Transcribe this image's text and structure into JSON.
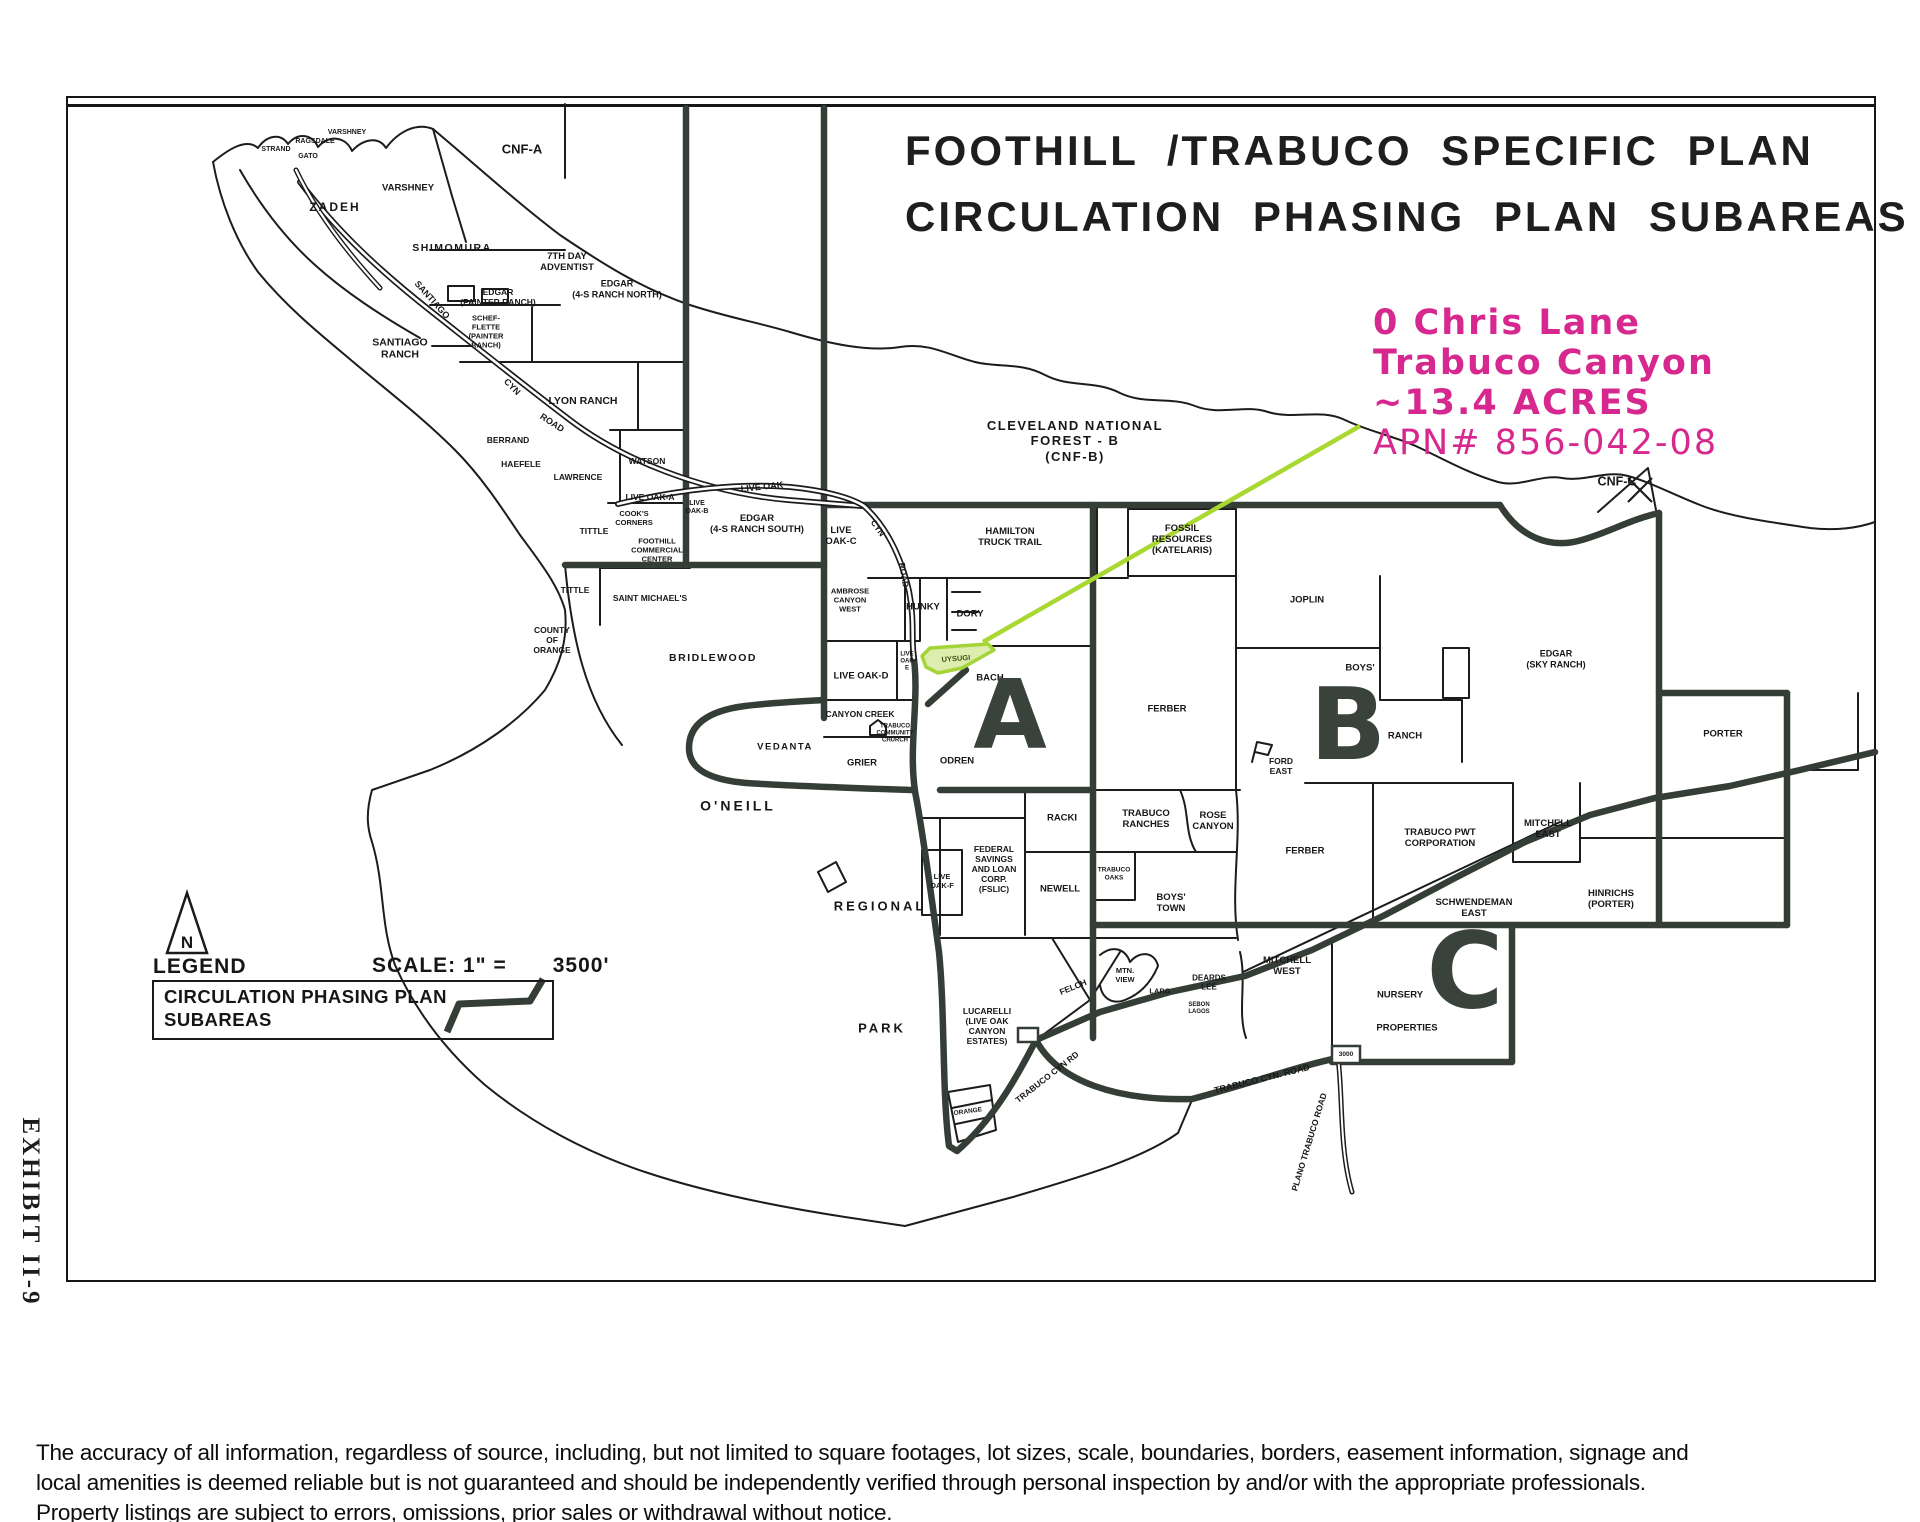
{
  "title": {
    "line1": "FOOTHILL /TRABUCO SPECIFIC PLAN",
    "line2": "CIRCULATION PHASING PLAN SUBAREAS"
  },
  "annotation": {
    "line1": "0 Chris Lane",
    "line2": "Trabuco Canyon",
    "line3": "~13.4 ACRES",
    "line4": "APN# 856-042-08",
    "text_color": "#d6288e",
    "leader_color": "#a9d832"
  },
  "exhibit": {
    "label": "EXHIBIT II-9"
  },
  "legend": {
    "heading": "LEGEND",
    "north_label": "N",
    "scale_label": "SCALE: 1\" =",
    "scale_value": "3500'",
    "box_line1": "CIRCULATION PHASING PLAN",
    "box_line2": "SUBAREAS"
  },
  "highlight": {
    "parcel_label": "UYSUGI",
    "fill": "#dcedad",
    "stroke": "#a4d437"
  },
  "subareas": [
    {
      "letter": "A",
      "x": 1010,
      "y": 716,
      "s": 95
    },
    {
      "letter": "B",
      "x": 1348,
      "y": 725,
      "s": 100
    },
    {
      "letter": "C",
      "x": 1465,
      "y": 972,
      "s": 105
    }
  ],
  "map_labels": [
    {
      "t": "CNF-A",
      "x": 522,
      "y": 149,
      "s": 13
    },
    {
      "t": "ZADEH",
      "x": 335,
      "y": 207,
      "s": 12,
      "ls": 2
    },
    {
      "t": "VARSHNEY",
      "x": 408,
      "y": 188,
      "s": 9.5
    },
    {
      "t": "VARSHNEY",
      "x": 347,
      "y": 133,
      "s": 7
    },
    {
      "t": "RAGSDALE",
      "x": 315,
      "y": 142,
      "s": 7
    },
    {
      "t": "STRAND",
      "x": 276,
      "y": 150,
      "s": 7
    },
    {
      "t": "GATO",
      "x": 308,
      "y": 157,
      "s": 7
    },
    {
      "t": "SHIMOMURA",
      "x": 452,
      "y": 248,
      "s": 10.5,
      "ls": 1.5
    },
    {
      "t": "7TH DAY\nADVENTIST",
      "x": 567,
      "y": 262,
      "s": 9.5
    },
    {
      "t": "EDGAR\n(PAINTER RANCH)",
      "x": 498,
      "y": 297,
      "s": 8.5
    },
    {
      "t": "SCHEF-\nFLETTE\n(PAINTER\nRANCH)",
      "x": 486,
      "y": 332,
      "s": 7.5
    },
    {
      "t": "SANTIAGO\nRANCH",
      "x": 400,
      "y": 349,
      "s": 10.5
    },
    {
      "t": "EDGAR\n(4-S RANCH NORTH)",
      "x": 617,
      "y": 289,
      "s": 9
    },
    {
      "t": "LYON RANCH",
      "x": 583,
      "y": 401,
      "s": 10.5
    },
    {
      "t": "BERRAND",
      "x": 508,
      "y": 440,
      "s": 8.5
    },
    {
      "t": "HAEFELE",
      "x": 521,
      "y": 464,
      "s": 8.5
    },
    {
      "t": "LAWRENCE",
      "x": 578,
      "y": 477,
      "s": 8.5
    },
    {
      "t": "WATSON",
      "x": 647,
      "y": 461,
      "s": 8.5
    },
    {
      "t": "LIVE OAK-A",
      "x": 650,
      "y": 497,
      "s": 8.5
    },
    {
      "t": "COOK'S\nCORNERS",
      "x": 634,
      "y": 519,
      "s": 7.5
    },
    {
      "t": "TITTLE",
      "x": 594,
      "y": 531,
      "s": 8.5
    },
    {
      "t": "TITTLE",
      "x": 575,
      "y": 590,
      "s": 8.5
    },
    {
      "t": "FOOTHILL\nCOMMERCIAL\nCENTER",
      "x": 657,
      "y": 551,
      "s": 7.5
    },
    {
      "t": "SAINT MICHAEL'S",
      "x": 650,
      "y": 598,
      "s": 8.5
    },
    {
      "t": "COUNTY\nOF\nORANGE",
      "x": 552,
      "y": 640,
      "s": 8.5
    },
    {
      "t": "BRIDLEWOOD",
      "x": 713,
      "y": 658,
      "s": 10.5,
      "ls": 1.5
    },
    {
      "t": "EDGAR\n(4-S RANCH SOUTH)",
      "x": 757,
      "y": 524,
      "s": 9.5
    },
    {
      "t": "LIVE\nOAK-B",
      "x": 697,
      "y": 508,
      "s": 7
    },
    {
      "t": "LIVE\nOAK-C",
      "x": 841,
      "y": 536,
      "s": 9.5
    },
    {
      "t": "CLEVELAND NATIONAL\nFOREST - B\n(CNF-B)",
      "x": 1075,
      "y": 441,
      "s": 13,
      "ls": 1.5
    },
    {
      "t": "HAMILTON\nTRUCK TRAIL",
      "x": 1010,
      "y": 537,
      "s": 9.5
    },
    {
      "t": "FOSSIL\nRESOURCES\n(KATELARIS)",
      "x": 1182,
      "y": 540,
      "s": 9.5
    },
    {
      "t": "JOPLIN",
      "x": 1307,
      "y": 600,
      "s": 9.5
    },
    {
      "t": "AMBROSE\nCANYON\nWEST",
      "x": 850,
      "y": 601,
      "s": 7.5
    },
    {
      "t": "HUNKY",
      "x": 923,
      "y": 607,
      "s": 9.5
    },
    {
      "t": "DORY",
      "x": 970,
      "y": 614,
      "s": 9.5
    },
    {
      "t": "LIVE\nOAK\nE",
      "x": 907,
      "y": 662,
      "s": 6
    },
    {
      "t": "LIVE OAK-D",
      "x": 861,
      "y": 676,
      "s": 9.5
    },
    {
      "t": "BACH",
      "x": 990,
      "y": 678,
      "s": 9.5
    },
    {
      "t": "CANYON CREEK",
      "x": 860,
      "y": 714,
      "s": 8.5
    },
    {
      "t": "TRABUCO\nCOMMUNITY\nCHURCH",
      "x": 895,
      "y": 734,
      "s": 6
    },
    {
      "t": "VEDANTA",
      "x": 785,
      "y": 747,
      "s": 9.5,
      "ls": 1.5
    },
    {
      "t": "GRIER",
      "x": 862,
      "y": 763,
      "s": 9.5
    },
    {
      "t": "ODREN",
      "x": 957,
      "y": 761,
      "s": 9.5
    },
    {
      "t": "O'NEILL",
      "x": 738,
      "y": 806,
      "s": 14,
      "ls": 3
    },
    {
      "t": "FERBER",
      "x": 1167,
      "y": 709,
      "s": 9.5
    },
    {
      "t": "BOYS'",
      "x": 1360,
      "y": 668,
      "s": 9.5
    },
    {
      "t": "RANCH",
      "x": 1405,
      "y": 736,
      "s": 9.5
    },
    {
      "t": "EDGAR\n(SKY RANCH)",
      "x": 1556,
      "y": 659,
      "s": 9
    },
    {
      "t": "PORTER",
      "x": 1723,
      "y": 734,
      "s": 9.5
    },
    {
      "t": "CNF-C",
      "x": 1617,
      "y": 482,
      "s": 12.5
    },
    {
      "t": "FORD\nEAST",
      "x": 1281,
      "y": 766,
      "s": 8.5
    },
    {
      "t": "RACKI",
      "x": 1062,
      "y": 818,
      "s": 9.5
    },
    {
      "t": "TRABUCO\nRANCHES",
      "x": 1146,
      "y": 819,
      "s": 9.5
    },
    {
      "t": "ROSE\nCANYON",
      "x": 1213,
      "y": 821,
      "s": 9.5
    },
    {
      "t": "FERBER",
      "x": 1305,
      "y": 851,
      "s": 9.5
    },
    {
      "t": "TRABUCO PWT\nCORPORATION",
      "x": 1440,
      "y": 838,
      "s": 9.5
    },
    {
      "t": "MITCHELL\nEAST",
      "x": 1548,
      "y": 829,
      "s": 9.5
    },
    {
      "t": "HINRICHS\n(PORTER)",
      "x": 1611,
      "y": 899,
      "s": 9.5
    },
    {
      "t": "SCHWENDEMAN\nEAST",
      "x": 1474,
      "y": 908,
      "s": 9.5
    },
    {
      "t": "FEDERAL\nSAVINGS\nAND LOAN\nCORP.\n(FSLIC)",
      "x": 994,
      "y": 869,
      "s": 8.5
    },
    {
      "t": "LIVE\nOAK-F",
      "x": 942,
      "y": 882,
      "s": 7.5
    },
    {
      "t": "NEWELL",
      "x": 1060,
      "y": 889,
      "s": 9.5
    },
    {
      "t": "TRABUCO\nOAKS",
      "x": 1114,
      "y": 874,
      "s": 6.5
    },
    {
      "t": "BOYS'\nTOWN",
      "x": 1171,
      "y": 903,
      "s": 9.5
    },
    {
      "t": "REGIONAL",
      "x": 880,
      "y": 906,
      "s": 13,
      "ls": 3
    },
    {
      "t": "MITCHELL\nWEST",
      "x": 1287,
      "y": 966,
      "s": 9.5
    },
    {
      "t": "NURSERY",
      "x": 1400,
      "y": 995,
      "s": 9.5
    },
    {
      "t": "PROPERTIES",
      "x": 1407,
      "y": 1028,
      "s": 9.5
    },
    {
      "t": "SEBON\nLAGOS",
      "x": 1199,
      "y": 1009,
      "s": 6
    },
    {
      "t": "MTN.\nVIEW",
      "x": 1125,
      "y": 976,
      "s": 7.5
    },
    {
      "t": "LARG",
      "x": 1160,
      "y": 992,
      "s": 7.5
    },
    {
      "t": "DEARDS\nLEE",
      "x": 1209,
      "y": 983,
      "s": 8
    },
    {
      "t": "LUCARELLI\n(LIVE OAK\nCANYON\nESTATES)",
      "x": 987,
      "y": 1026,
      "s": 8.5
    },
    {
      "t": "PARK",
      "x": 882,
      "y": 1028,
      "s": 13,
      "ls": 3
    },
    {
      "t": "ORANGE",
      "x": 968,
      "y": 1112,
      "s": 6.5,
      "r": -8
    },
    {
      "t": "3000",
      "x": 1346,
      "y": 1055,
      "s": 6.5
    },
    {
      "t": "SANTIAGO",
      "x": 432,
      "y": 300,
      "s": 9,
      "r": 48
    },
    {
      "t": "CYN",
      "x": 512,
      "y": 387,
      "s": 9,
      "r": 45
    },
    {
      "t": "ROAD",
      "x": 552,
      "y": 423,
      "s": 9,
      "r": 33
    },
    {
      "t": "LIVE OAK",
      "x": 762,
      "y": 487,
      "s": 9,
      "r": -6
    },
    {
      "t": "CYN",
      "x": 878,
      "y": 528,
      "s": 8.5,
      "r": 55
    },
    {
      "t": "ROAD",
      "x": 904,
      "y": 575,
      "s": 8.5,
      "r": 80
    },
    {
      "t": "TRABUCO CYN RD",
      "x": 1047,
      "y": 1077,
      "s": 8.5,
      "r": -38
    },
    {
      "t": "FELCH",
      "x": 1073,
      "y": 987,
      "s": 8.5,
      "r": -22
    },
    {
      "t": "TRABUCO CYN. ROAD",
      "x": 1262,
      "y": 1079,
      "s": 9,
      "r": -14
    },
    {
      "t": "PLANO TRABUCO ROAD",
      "x": 1309,
      "y": 1142,
      "s": 8.5,
      "r": -73
    }
  ],
  "disclaimer": {
    "line1": "The accuracy of all information, regardless of source, including, but not limited to square footages, lot sizes, scale, boundaries, borders, easement information, signage and",
    "line2": "local amenities is deemed reliable but is not guaranteed and should be independently verified through personal inspection by and/or with the appropriate professionals.",
    "line3": "Property listings are subject to errors, omissions, prior sales or withdrawal without notice."
  }
}
